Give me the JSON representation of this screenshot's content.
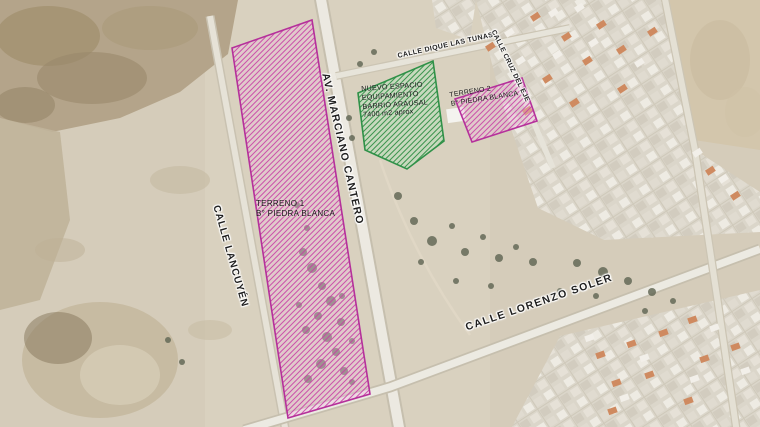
{
  "map": {
    "streets": {
      "marciano_cantero": "AV. MARCIANO CANTERO",
      "lancuyen": "CALLE LANCUYÉN",
      "dique_las_tunas": "CALLE DIQUE LAS TUNAS",
      "cruz_del_eje": "CALLE CRUZ DEL EJE",
      "lorenzo_soler": "CALLE LORENZO SOLER"
    },
    "parcels": {
      "terreno1": {
        "name": "TERRENO 1",
        "barrio": "B° PIEDRA BLANCA"
      },
      "terreno2": {
        "name": "TERRENO 2",
        "barrio": "B° PIEDRA BLANCA"
      },
      "nuevo_espacio": {
        "line1": "NUEVO ESPACIO",
        "line2": "EQUIPAMIENTO",
        "line3": "BARRIO ARAUSAL",
        "line4": "7400 m2 aprox"
      }
    },
    "colors": {
      "parcel_outline_magenta": "#b5309b",
      "parcel_outline_green": "#2f9148"
    }
  }
}
